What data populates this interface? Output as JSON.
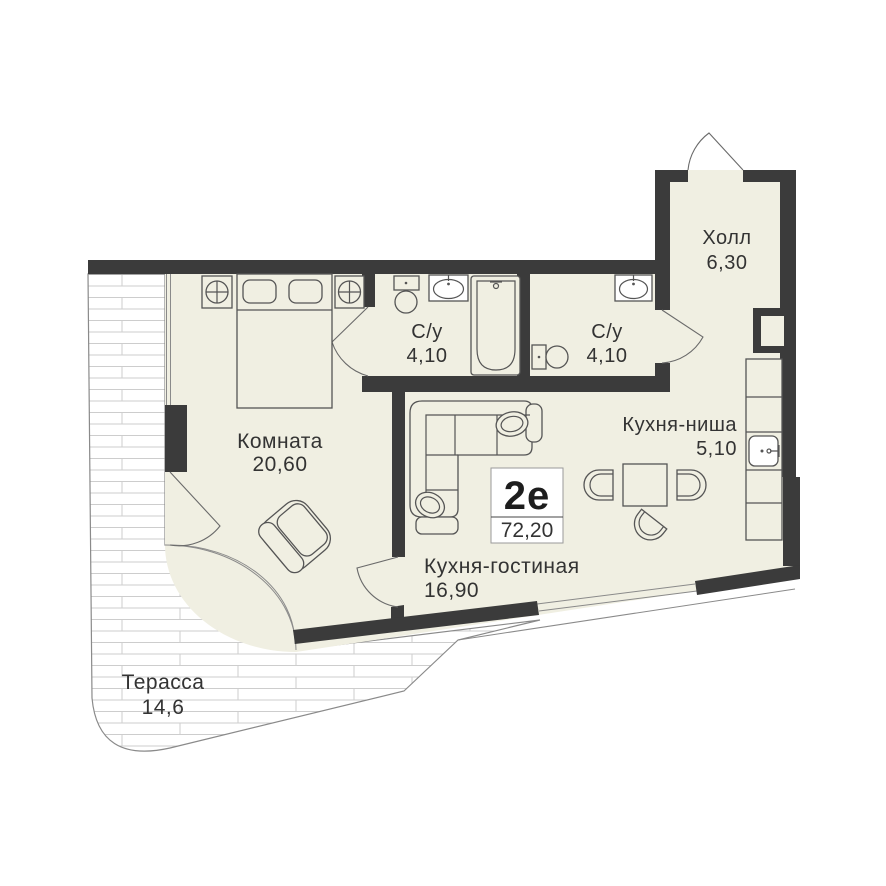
{
  "plan": {
    "title": "Apartment floor plan",
    "badge": {
      "type": "2е",
      "area": "72,20"
    },
    "rooms": {
      "hall": {
        "name": "Холл",
        "area": "6,30"
      },
      "bath1": {
        "name": "С/у",
        "area": "4,10"
      },
      "bath2": {
        "name": "С/у",
        "area": "4,10"
      },
      "room": {
        "name": "Комната",
        "area": "20,60"
      },
      "kitchen_niche": {
        "name": "Кухня-ниша",
        "area": "5,10"
      },
      "kitchen_living": {
        "name": "Кухня-гостиная",
        "area": "16,90"
      },
      "terrace": {
        "name": "Терасса",
        "area": "14,6"
      }
    },
    "fixtures": [
      "double-bed",
      "nightstand-lamp",
      "nightstand-lamp",
      "armchair",
      "corner-sofa",
      "ottoman",
      "dining-table",
      "chair",
      "chair",
      "chair",
      "kitchen-counter",
      "kitchen-sink",
      "bathtub",
      "washbasin",
      "toilet",
      "washbasin",
      "toilet",
      "duct-shaft",
      "entrance-door"
    ],
    "colors": {
      "wall": "#3b3b3b",
      "floor": "#f0efe2",
      "line": "#555555",
      "terrace_edge": "#8a8a8a",
      "terrace_line": "#cdcdcd",
      "text": "#333333"
    }
  }
}
